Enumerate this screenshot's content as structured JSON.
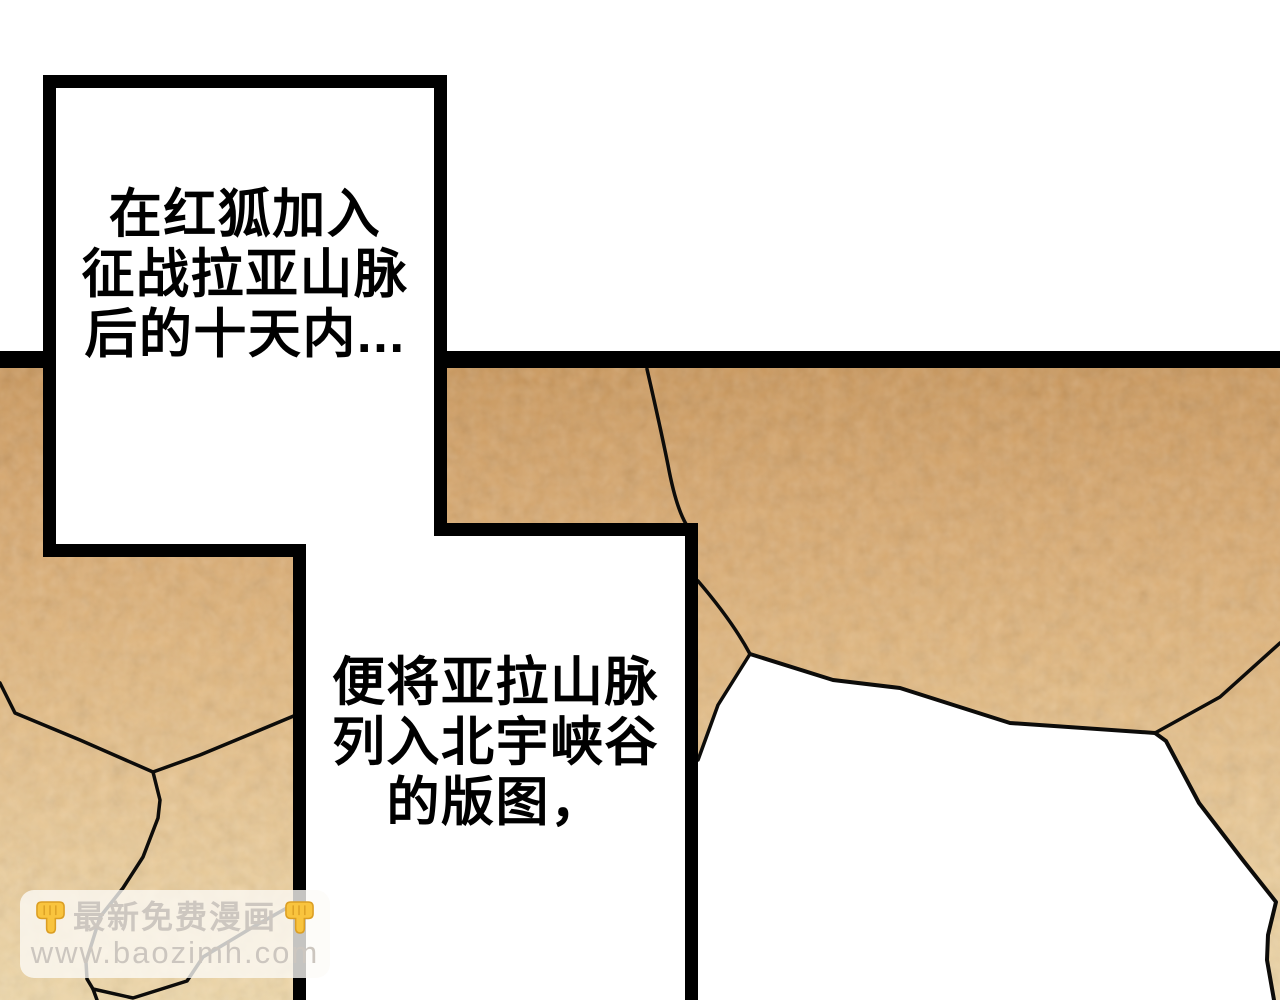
{
  "comic": {
    "narration_boxes": [
      {
        "lines": [
          "在红狐加入",
          "征战拉亚山脉",
          "后的十天内..."
        ]
      },
      {
        "lines": [
          "便将亚拉山脉",
          "列入北宇峡谷",
          "的版图，"
        ]
      }
    ],
    "watermark": {
      "title": "最新免费漫画",
      "url": "www.baozimh.com",
      "emoji": "backhand-index-pointing-down",
      "text_color": "#cdc7c0",
      "emoji_color": "#F9C43E"
    },
    "colors": {
      "ink": "#000000",
      "ground_top": "#cb995e",
      "ground_mid": "#e0b67e",
      "ground_bottom": "#eed7a9",
      "crack": "#0d0c0a",
      "gap_white": "#ffffff"
    }
  }
}
